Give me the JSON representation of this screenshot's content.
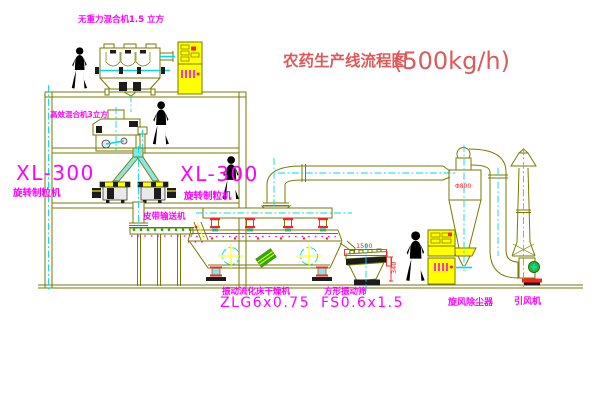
{
  "title": {
    "text": "农药生产线流程图",
    "capacity": "(500kg/h)"
  },
  "equipment_labels": {
    "gravity_mixer": "无重力混合机1.5 立方",
    "high_eff_mixer": "高效混合机3立方",
    "granulator_left": {
      "model": "XL-300",
      "name": "旋转制粒机"
    },
    "granulator_right": {
      "model": "XL-300",
      "name": "旋转制粒机"
    },
    "belt_conveyor": "皮带输送机",
    "fluid_bed_dryer": {
      "name": "振动流化床干燥机",
      "model": "ZLG6x0.75"
    },
    "vibrating_sieve": {
      "name": "方形振动筛",
      "model": "FS0.6x1.5"
    },
    "cyclone": "旋风除尘器",
    "fan": "引风机"
  },
  "dimensions": {
    "cyclone_diameter": "Φ800",
    "sieve_length": "1500",
    "sieve_height": "340"
  },
  "colors": {
    "line": "#7a7a00",
    "centerline": "#00dcdc",
    "label": "#ff00ff",
    "title": "#dd5a5a",
    "dimension": "#ff2020",
    "cabinet_yellow": "#ffff00",
    "accent_green": "#00bb00",
    "accent_red": "#ff2020",
    "background": "#ffffff"
  }
}
